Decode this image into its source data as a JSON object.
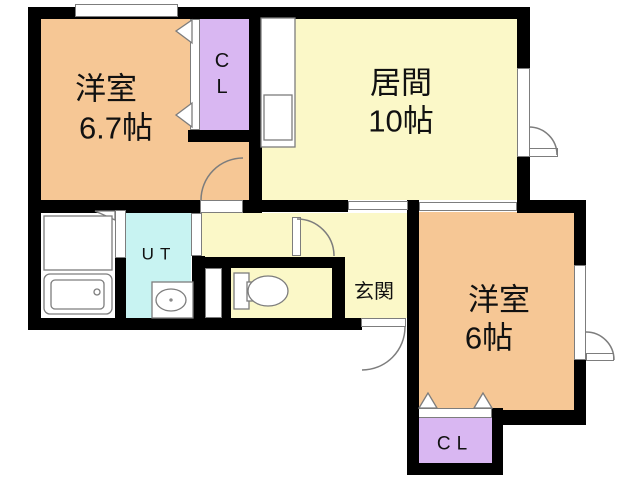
{
  "plan": {
    "type": "floor-plan",
    "rooms": {
      "western_6_7": {
        "name": "洋室",
        "size": "6.7帖"
      },
      "living": {
        "name": "居間",
        "size": "10帖"
      },
      "western_6": {
        "name": "洋室",
        "size": "6帖"
      },
      "utility": {
        "label": "UT"
      },
      "entrance": {
        "label": "玄関"
      },
      "closet_top": {
        "char1": "C",
        "char2": "L"
      },
      "closet_bottom": {
        "label": "CL"
      }
    },
    "fixtures": [
      "kitchen-counter",
      "bathtub",
      "washstand",
      "washer-pan",
      "toilet"
    ],
    "colors": {
      "wall": "#000000",
      "room_orange": "#F6C795",
      "living_yellow": "#FBF8C8",
      "closet_purple": "#D9B7F2",
      "water_cyan": "#C8F3F2",
      "outline_gray": "#7d7d7d",
      "text": "#111111"
    }
  }
}
